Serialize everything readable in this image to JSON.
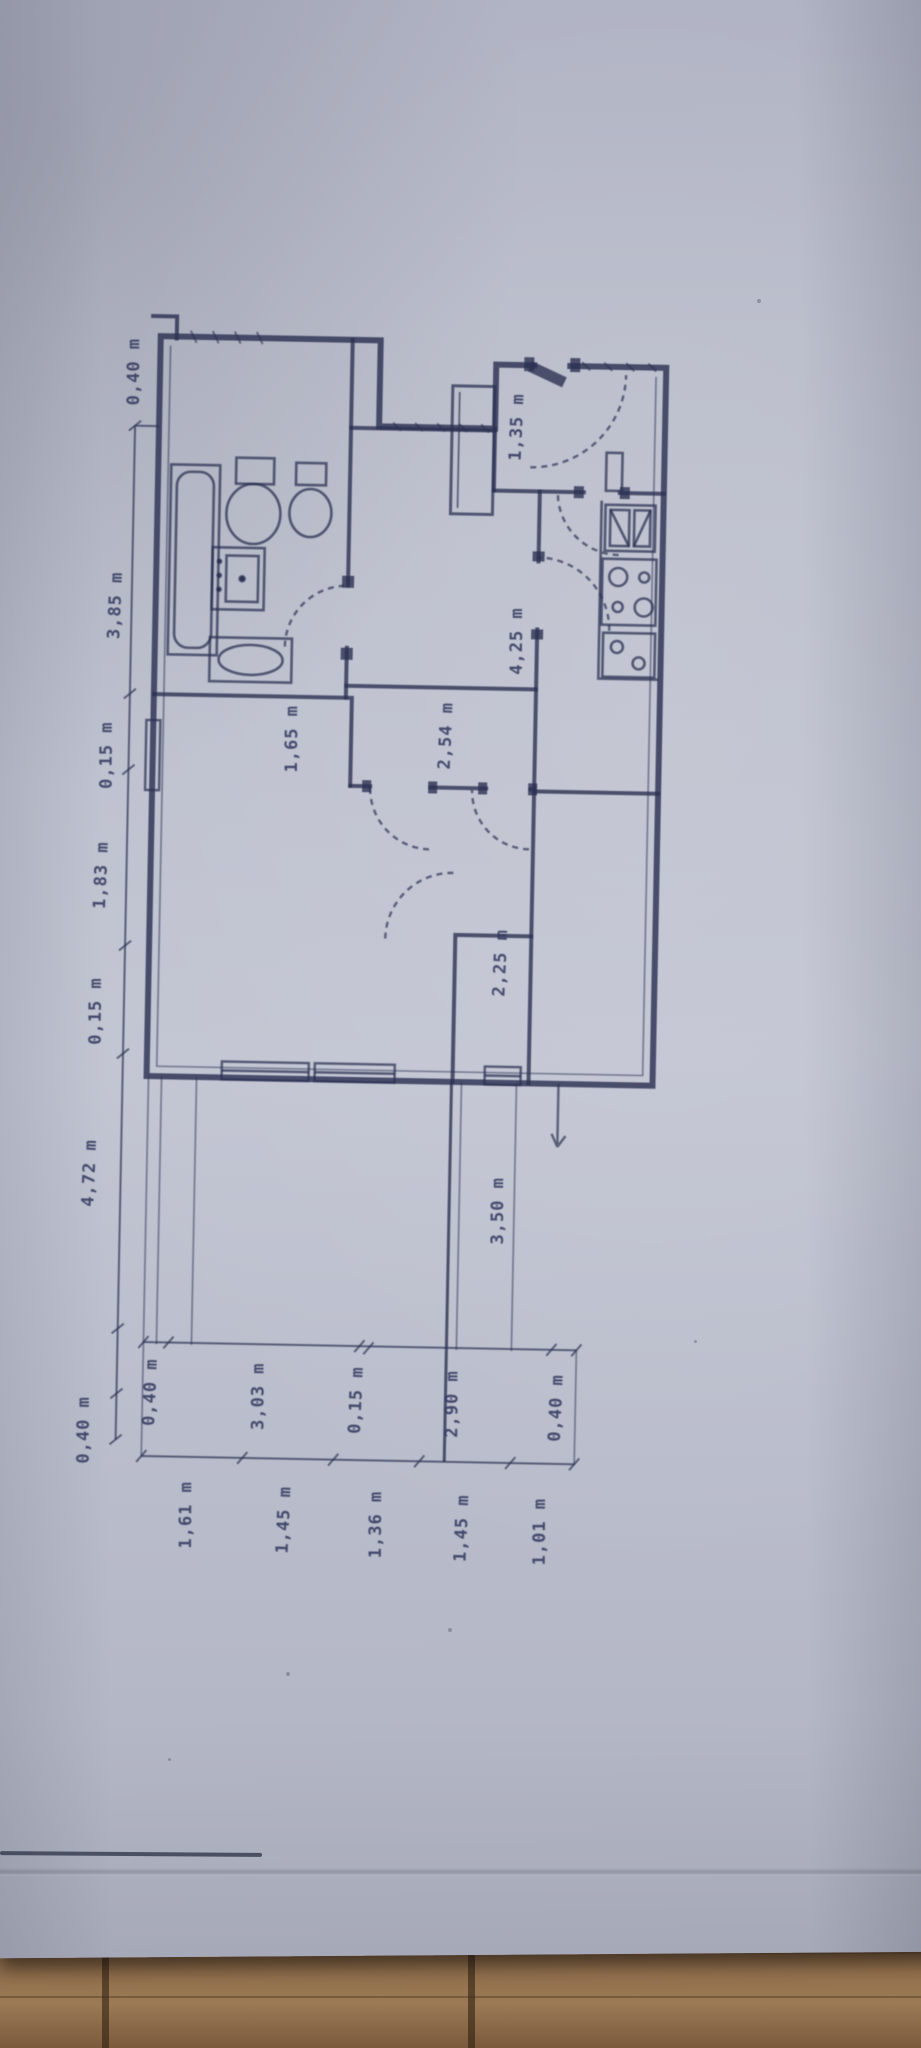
{
  "colors": {
    "paper": "#b8bbc9",
    "ink": "#2e3354",
    "ink_soft": "#353b60",
    "wood": "#8a6847",
    "wood_dark": "#5f4630"
  },
  "dimensions": {
    "left_chain": [
      "0,40 m",
      "3,85 m",
      "0,15 m",
      "1,83 m",
      "0,15 m",
      "4,72 m",
      "0,40 m"
    ],
    "interior": {
      "entry": "1,35 m",
      "kitchen": "4,25 m",
      "corridor": "2,54 m",
      "bathroom": "1,65 m",
      "closet": "2,25 m",
      "lower_left_room": "3,50 m"
    },
    "bottom_chain_upper": [
      "0,40 m",
      "3,03 m",
      "0,15 m",
      "2,90 m",
      "0,40 m"
    ],
    "bottom_chain_lower": [
      "1,61 m",
      "1,45 m",
      "1,36 m",
      "1,45 m",
      "1,01 m"
    ]
  }
}
